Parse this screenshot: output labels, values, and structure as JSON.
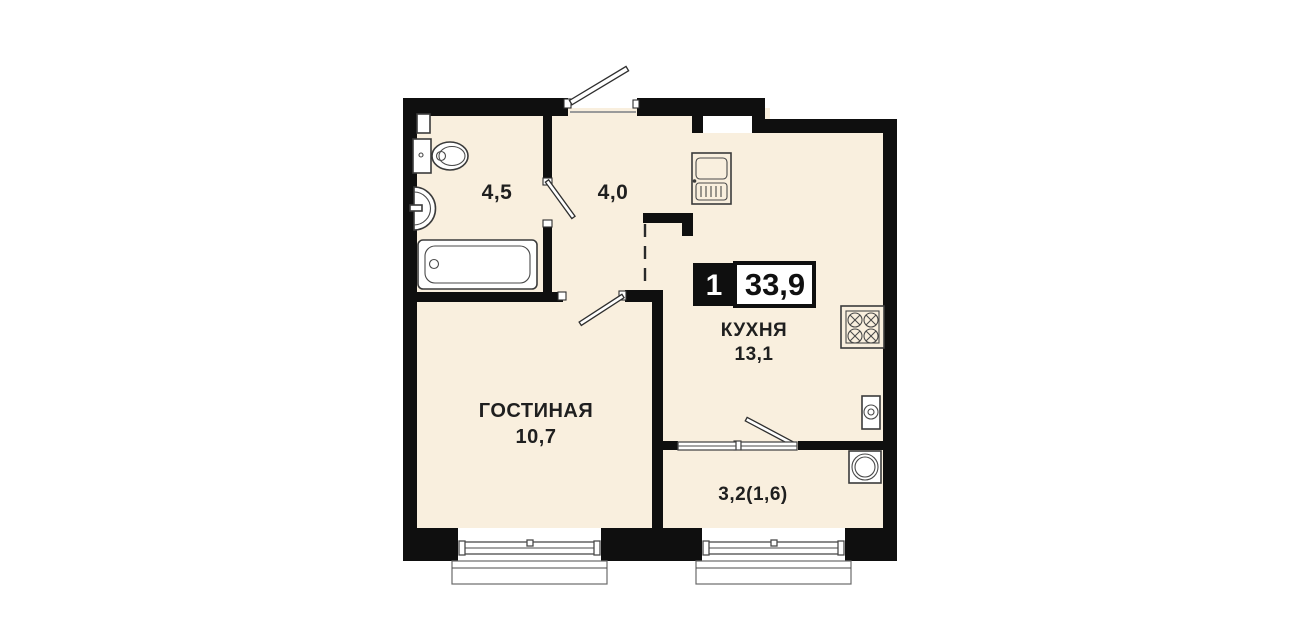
{
  "plan": {
    "badge": {
      "room_count": "1",
      "total_area": "33,9"
    },
    "rooms": {
      "bathroom": {
        "area": "4,5"
      },
      "hallway": {
        "area": "4,0"
      },
      "kitchen": {
        "name": "КУХНЯ",
        "area": "13,1"
      },
      "living_room": {
        "name": "ГОСТИНАЯ",
        "area": "10,7"
      },
      "balcony": {
        "area": "3,2(1,6)"
      }
    },
    "colors": {
      "wall": "#0f0f0f",
      "floor": "#f9efde",
      "fixture_line": "#3b3b3b",
      "label_text": "#1f1f1f",
      "badge_background": "#0f0f0f",
      "badge_number_text": "#ffffff",
      "badge_area_text": "#101010",
      "page_background": "#ffffff"
    },
    "fixtures": [
      "toilet",
      "bathroom-sink",
      "bathtub",
      "kitchen-sink",
      "stove",
      "water-heater",
      "washing-machine"
    ],
    "openings": [
      "entrance-door",
      "bathroom-door",
      "living-room-door",
      "balcony-door",
      "living-room-window",
      "balcony-window"
    ]
  }
}
